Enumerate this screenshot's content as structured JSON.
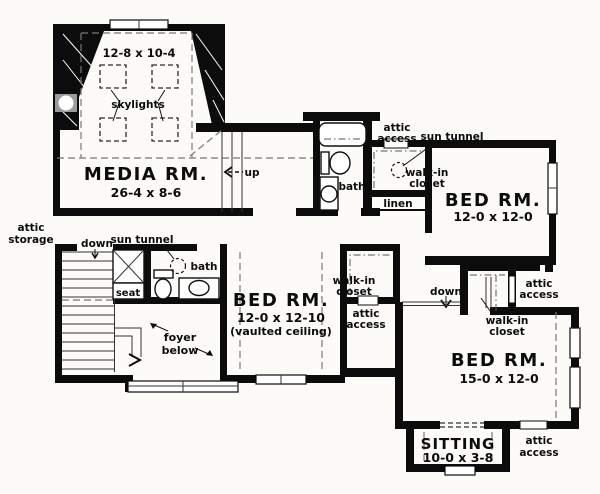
{
  "meta": {
    "title": "Second floor plan"
  },
  "colors": {
    "background": "#fcfbf8",
    "wall": "#0c0c0c",
    "dashed_line": "#777777"
  },
  "rooms": {
    "media": {
      "name": "MEDIA RM.",
      "dims": "26-4 x 8-6",
      "skylight_area_dims": "12-8 x 10-4"
    },
    "bed1": {
      "name": "BED RM.",
      "dims": "12-0 x 12-0"
    },
    "bed2": {
      "name": "BED RM.",
      "dims": "12-0 x 12-10",
      "note": "(vaulted ceiling)"
    },
    "bed3": {
      "name": "BED RM.",
      "dims": "15-0 x 12-0"
    },
    "sitting": {
      "name": "SITTING",
      "dims": "10-0 x 3-8"
    }
  },
  "labels": {
    "skylights": "skylights",
    "up": "up",
    "down": "down",
    "bath": "bath",
    "linen": "linen",
    "seat": "seat",
    "sun_tunnel": "sun tunnel",
    "attic_storage": {
      "l1": "attic",
      "l2": "storage"
    },
    "attic_access": {
      "l1": "attic",
      "l2": "access"
    },
    "walk_in_closet": {
      "l1": "walk-in",
      "l2": "closet"
    },
    "foyer_below": {
      "l1": "foyer",
      "l2": "below"
    }
  }
}
